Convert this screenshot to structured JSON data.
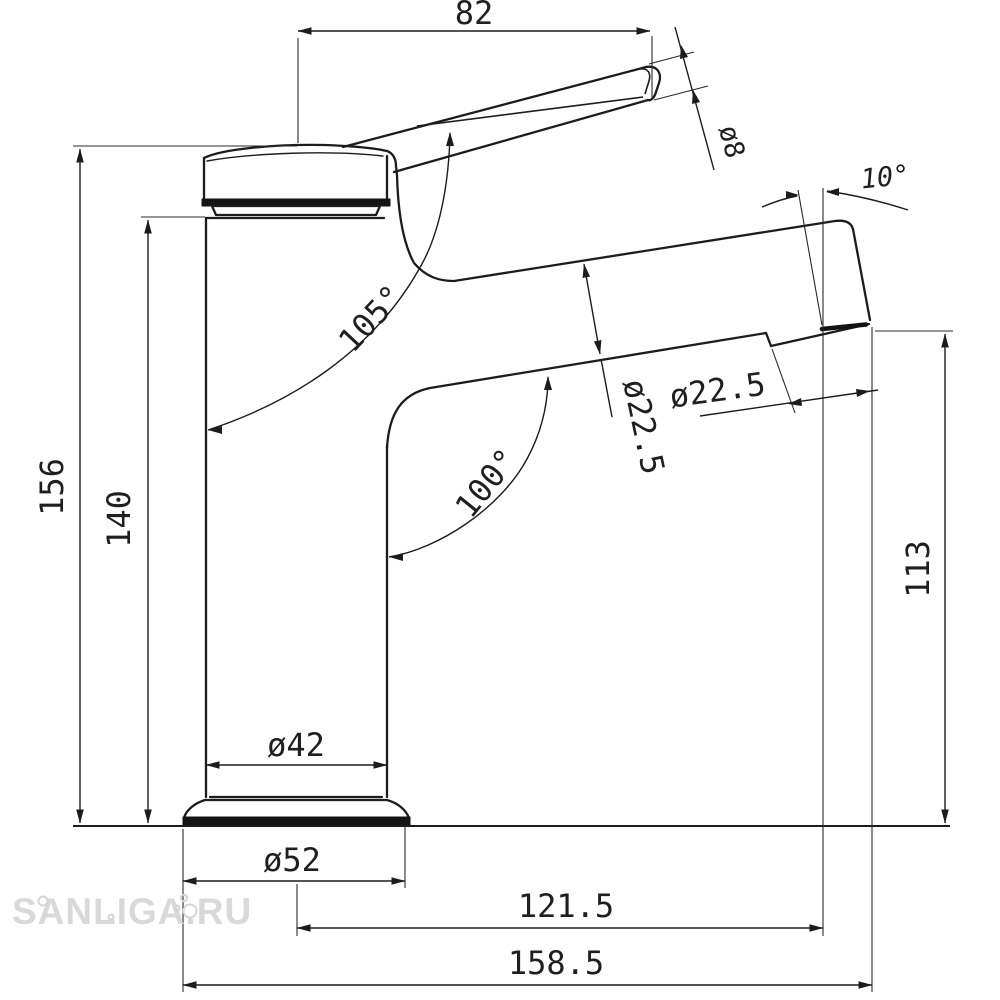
{
  "watermark": "SANLIGA.RU",
  "drawing_type": "faucet-dimensional-drawing",
  "dims": {
    "handle_length": "82",
    "handle_dia": "ø8",
    "spout_tilt_angle": "10°",
    "handle_angle": "105°",
    "spout_angle": "100°",
    "spout_dia": "ø22.5",
    "aerator_dia": "ø22.5",
    "spout_outlet_height": "113",
    "total_height": "156",
    "body_height": "140",
    "body_dia": "ø42",
    "base_dia": "ø52",
    "spout_reach": "121.5",
    "total_reach": "158.5"
  }
}
